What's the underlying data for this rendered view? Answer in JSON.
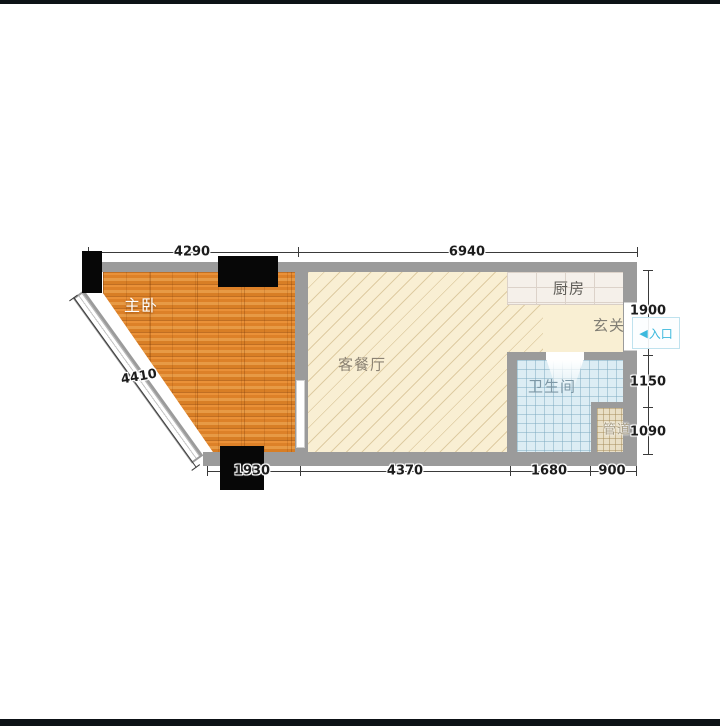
{
  "plan": {
    "type": "apartment-floor-plan",
    "rooms": [
      {
        "id": "bedroom",
        "label": "主卧"
      },
      {
        "id": "living-dining",
        "label": "客餐厅"
      },
      {
        "id": "kitchen",
        "label": "厨房"
      },
      {
        "id": "entry-hall",
        "label": "玄关"
      },
      {
        "id": "bathroom",
        "label": "卫生间"
      },
      {
        "id": "duct",
        "label": "管道"
      }
    ],
    "entrance": {
      "arrow": "◀",
      "label": "入口"
    },
    "dimensions": {
      "top": [
        "4290",
        "6940"
      ],
      "bottom": [
        "1930",
        "4370",
        "1680",
        "900"
      ],
      "right": [
        "1900",
        "1150",
        "1090"
      ],
      "diagonal": [
        "4410"
      ]
    }
  },
  "colors": {
    "wall": "#9b9b9b",
    "wood": "#e0852c",
    "cream": "#f9efd3",
    "bath": "#dcedf4",
    "cyan": "#3db9dd",
    "dim": "#3a3a3a",
    "bar": "#0d1216"
  }
}
